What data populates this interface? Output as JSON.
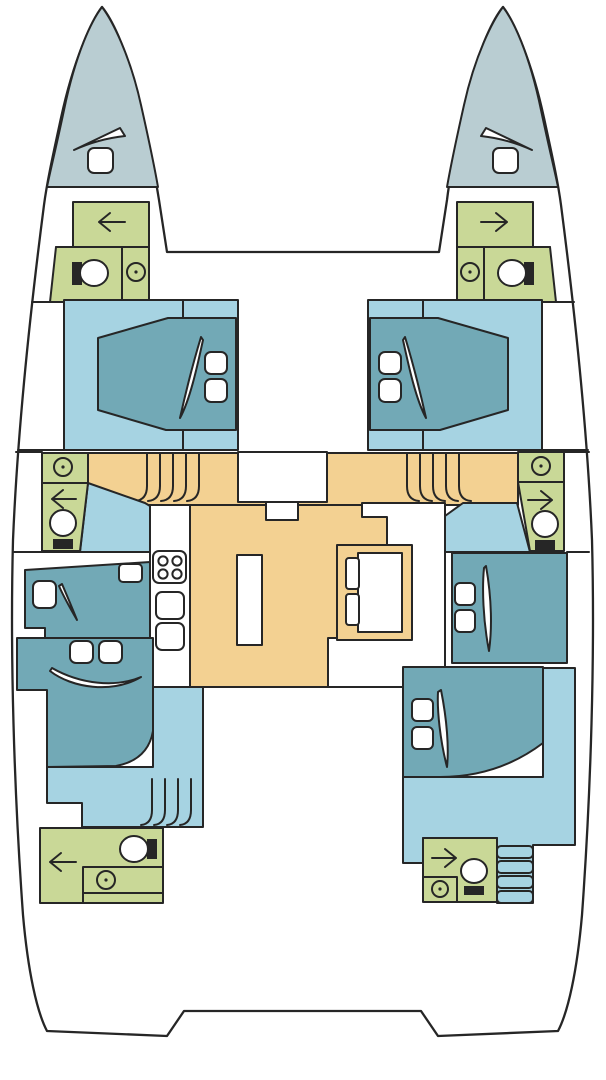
{
  "diagram": {
    "kind": "catamaran-yacht-deck-plan",
    "view": "top-down, bow up",
    "symmetry": "port and starboard hulls mirrored about the centerline",
    "text_labels": []
  },
  "palette": {
    "line": "#262626",
    "bow_deck": "#b9cdd2",
    "head_green": "#c9d897",
    "cabin_floor": "#a6d3e2",
    "bed_teal": "#72a9b6",
    "salon_floor": "#f3d192",
    "white": "#ffffff"
  },
  "rooms": [
    {
      "id": "port-bow-deck",
      "color": "bow_deck",
      "fixtures": [
        "deck-hatch",
        "sail-locker-lid"
      ]
    },
    {
      "id": "starboard-bow-deck",
      "color": "bow_deck",
      "fixtures": [
        "deck-hatch",
        "sail-locker-lid"
      ]
    },
    {
      "id": "port-forward-head",
      "color": "head_green",
      "fixtures": [
        "toilet-with-tank",
        "washbasin",
        "door-swing-arrow-left",
        "shower-stall"
      ]
    },
    {
      "id": "starboard-forward-head",
      "color": "head_green",
      "fixtures": [
        "toilet-with-tank",
        "washbasin",
        "door-swing-arrow-right",
        "shower-stall"
      ]
    },
    {
      "id": "port-forward-cabin",
      "color": "cabin_floor",
      "fixtures": [
        "double-bed",
        "pillow",
        "pillow",
        "duvet-fold"
      ]
    },
    {
      "id": "starboard-forward-cabin",
      "color": "cabin_floor",
      "fixtures": [
        "double-bed",
        "pillow",
        "pillow",
        "duvet-fold"
      ]
    },
    {
      "id": "port-mid-head",
      "color": "head_green",
      "fixtures": [
        "washbasin",
        "door-swing-arrow-left",
        "toilet"
      ]
    },
    {
      "id": "starboard-mid-head",
      "color": "head_green",
      "fixtures": [
        "washbasin",
        "door-swing-arrow-right",
        "toilet"
      ]
    },
    {
      "id": "salon",
      "color": "salon_floor",
      "fixtures": [
        "entry-console",
        "galley-counter",
        "stove-4-burner",
        "galley-sink",
        "galley-sink",
        "island-counter",
        "dinette-table",
        "dinette-seat",
        "dinette-seat",
        "u-shaped-bench",
        "companionway-steps-port",
        "companionway-steps-starboard"
      ]
    },
    {
      "id": "port-mid-berth",
      "color": "bed_teal",
      "fixtures": [
        "single-berth",
        "pillow",
        "cushion",
        "duvet-fold"
      ]
    },
    {
      "id": "starboard-mid-cabin",
      "color": "bed_teal",
      "fixtures": [
        "double-bed",
        "pillow",
        "pillow",
        "duvet-fold"
      ]
    },
    {
      "id": "port-aft-cabin",
      "color": "cabin_floor",
      "fixtures": [
        "double-bed",
        "pillow",
        "pillow",
        "duvet-fold",
        "companionway-steps"
      ]
    },
    {
      "id": "starboard-aft-cabin",
      "color": "cabin_floor",
      "fixtures": [
        "double-bed",
        "pillow",
        "pillow",
        "duvet-fold",
        "companionway-steps"
      ]
    },
    {
      "id": "port-aft-head",
      "color": "head_green",
      "fixtures": [
        "toilet-with-tank",
        "washbasin-counter",
        "door-swing-arrow-left"
      ]
    },
    {
      "id": "starboard-aft-head",
      "color": "head_green",
      "fixtures": [
        "toilet-with-tank",
        "washbasin",
        "door-swing-arrow-right"
      ]
    }
  ],
  "icons": [
    "deck-hatch-icon",
    "sail-locker-icon",
    "toilet-icon",
    "washbasin-icon",
    "door-arrow-icon",
    "stove-icon",
    "sink-icon",
    "pillow-icon",
    "duvet-fold-icon",
    "steps-icon",
    "table-icon",
    "seat-icon"
  ]
}
